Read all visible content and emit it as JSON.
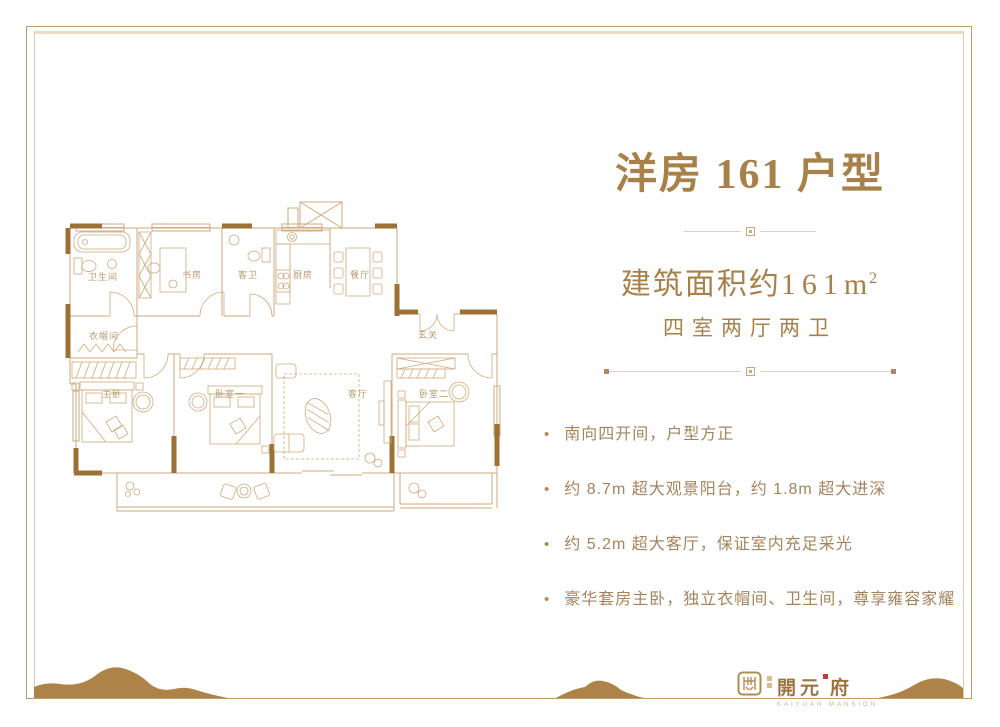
{
  "title": "洋房 161 户型",
  "area_line": {
    "label": "建筑面积约",
    "value": "161",
    "unit": "m",
    "sup": "2"
  },
  "layout_line": "四室两厅两卫",
  "bullet_char": "•",
  "features": [
    "南向四开间，户型方正",
    "约 8.7m 超大观景阳台，约 1.8m 超大进深",
    "约 5.2m 超大客厅，保证室内充足采光",
    "豪华套房主卧，独立衣帽间、卫生间，尊享雍容家耀"
  ],
  "floorplan": {
    "rooms": [
      "卫生间",
      "书房",
      "客卫",
      "厨房",
      "餐厅",
      "衣帽间",
      "玄关",
      "主卧",
      "卧室一",
      "客厅",
      "卧室二"
    ]
  },
  "logo": {
    "name_a": "開元",
    "name_b": "府",
    "subtitle": "KAIYUAN MANSION"
  },
  "colors": {
    "accent": "#a8814a",
    "feature_text": "#a6835c",
    "plan_line": "#cfa97c",
    "plan_wall": "#9d7033",
    "divider": "#e2d2b2",
    "hill": "#ad8347",
    "seal_red": "#c23b2e"
  }
}
